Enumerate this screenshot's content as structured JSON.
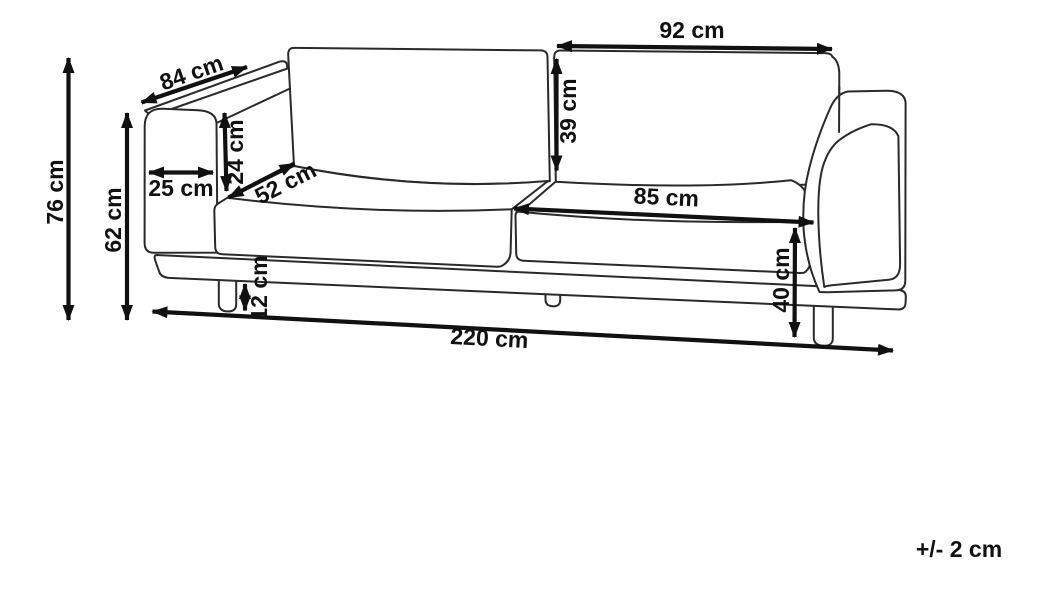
{
  "diagram": {
    "subject": "sofa-dimension-diagram",
    "unit": "cm",
    "tolerance": "+/- 2 cm",
    "colors": {
      "background": "#ffffff",
      "sofa_outline": "#2a2a2a",
      "dimension_lines": "#111111"
    },
    "dimensions": {
      "overall_height": "76 cm",
      "armrest_height": "62 cm",
      "depth": "84 cm",
      "armrest_top_above_seat": "24 cm",
      "armrest_width": "25 cm",
      "seat_depth": "52 cm",
      "back_cushion_width": "92 cm",
      "back_cushion_height": "39 cm",
      "seat_cushion_width": "85 cm",
      "seat_height": "40 cm",
      "leg_height": "12 cm",
      "overall_width": "220 cm"
    }
  }
}
